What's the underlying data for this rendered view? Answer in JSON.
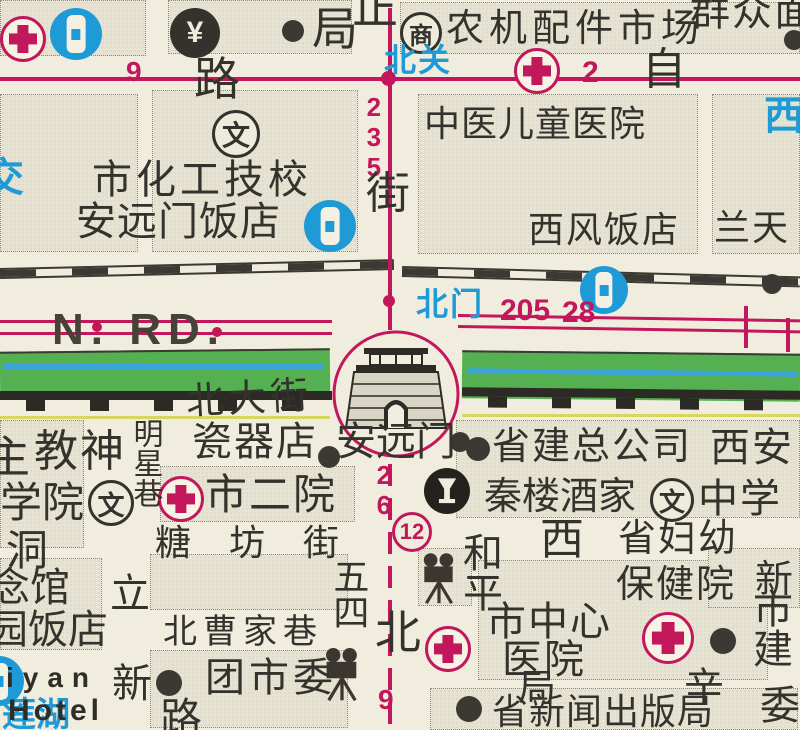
{
  "map": {
    "colors": {
      "route_red": "#c2185b",
      "stop_blue": "#1e9ad6",
      "moat_green": "#55b052",
      "water_blue": "#3aa4da",
      "ink": "#34322c",
      "paper": "#f1edde",
      "block_fill": "#e7e3d2"
    },
    "labels": {
      "ju_top": "局",
      "lu_top": "路",
      "zheng_partial": "正",
      "jie": "街",
      "zi": "自",
      "beiguan_stop": "北关",
      "beimen_stop": "北门",
      "nongji_market": "农机配件市场",
      "qunzhong_partial": "群众面",
      "shang_glyph": "商",
      "wen_glyph": "文",
      "yuan_glyph": "¥",
      "zhongyi_hospital": "中医儿童医院",
      "xifeng_hotel": "西风饭店",
      "lantian": "兰天",
      "xi_blue_partial": "西",
      "jiao_blue_partial": "交",
      "shihuagong_school": "市化工技校",
      "anyuanmen_hotel": "安远门饭店",
      "north_road": "N. RD.",
      "beidajie": "北大街",
      "ciqidian": "瓷器店",
      "anyuanmen_gate": "安远门",
      "zhu_partial": "主",
      "jiaoshen": "教神",
      "xueyuan": "学院",
      "mingxingxiang": "明星巷",
      "shieryuan": "市二院",
      "dong_partial": "洞",
      "tangfangjie": "糖坊街",
      "wusi": "五四",
      "bei_street": "北",
      "li_street": "立",
      "xin_street": "新",
      "lu_bottom": "路",
      "beicaojiaxiang": "北曹家巷",
      "tuanshiwei": "团市委",
      "nianguan_partial": "念馆",
      "yuanfandian_partial": "园饭店",
      "iyan_partial": "iyan",
      "hotel_en": "Hotel",
      "lianhu_blue": "莲湖",
      "heping": "和平",
      "xi_big": "西",
      "shengfuyou": "省妇幼",
      "baojianyuan": "保健院",
      "shizhongxin": "市中心",
      "yiyuan": "医院",
      "ju_small": "局",
      "shengxinwen_bureau": "省新闻出版局",
      "xin_right": "新",
      "shijian_v": "市建",
      "wei_v": "委",
      "xing_partial": "辛",
      "shengjian_company": "省建总公司",
      "xian": "西安",
      "qinlou_restaurant": "秦楼酒家",
      "zhongxue": "中学"
    },
    "routes": {
      "r9_top": "9",
      "r2": "2",
      "r235": "235",
      "r205": "205",
      "r28": "28",
      "r26": "26",
      "r12": "12",
      "r9_bottom": "9"
    }
  }
}
